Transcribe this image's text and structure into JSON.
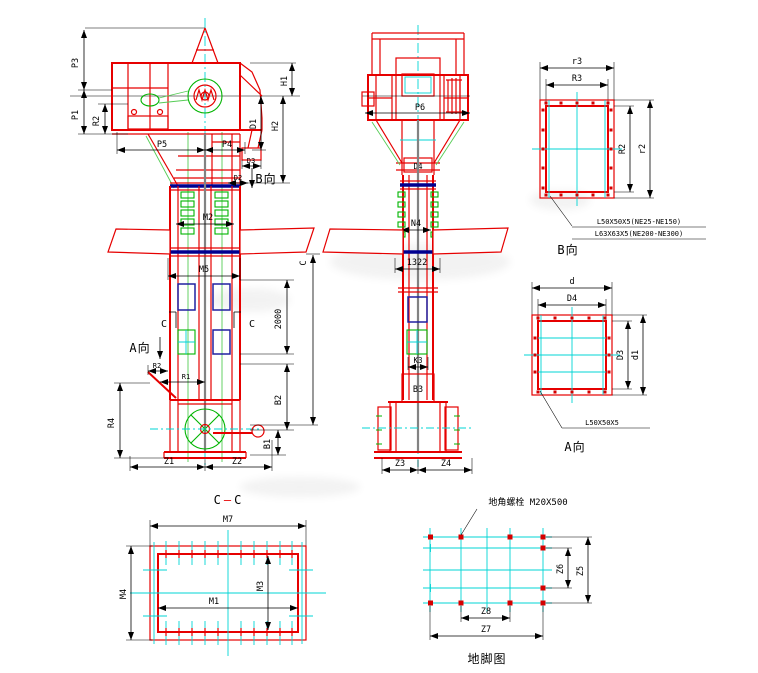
{
  "drawing": {
    "front": {
      "p3": "P3",
      "p1": "P1",
      "r2_head": "R2",
      "p5": "P5",
      "p4": "P4",
      "h1": "H1",
      "h2": "H2",
      "d1": "D1",
      "d3": "D3",
      "d2": "D2",
      "b_arrow": "B向",
      "m2": "M2",
      "m5": "M5",
      "dim_2000": "2000",
      "c_len": "C",
      "c_cut_left": "C",
      "c_cut_right": "C",
      "a_arrow": "A向",
      "r2": "R2",
      "r1": "R1",
      "r4": "R4",
      "b2": "B2",
      "b1": "B1",
      "z1": "Z1",
      "z2": "Z2"
    },
    "side": {
      "p6": "P6",
      "d4": "D4",
      "n4": "N4",
      "dim_1322": "1322",
      "k3": "K3",
      "b3": "B3",
      "z3": "Z3",
      "z4": "Z4"
    },
    "view_b": {
      "r3_outer": "r3",
      "r3_inner": "R3",
      "r2_inner": "R2",
      "r2_outer": "r2",
      "angle_note_small": "L50X50X5(NE25-NE150)",
      "angle_note_large": "L63X63X5(NE200-NE300)",
      "title": "B向"
    },
    "view_a": {
      "d_outer": "d",
      "d4_inner": "D4",
      "d3": "D3",
      "d1": "d1",
      "angle_note": "L50X50X5",
      "title": "A向"
    },
    "section_cc": {
      "title_left": "C",
      "title_dash": "—",
      "title_right": "C",
      "m7": "M7",
      "m4": "M4",
      "m3": "M3",
      "m1": "M1"
    },
    "foundation": {
      "bolt_note": "地角螺栓 M20X500",
      "z6": "Z6",
      "z5": "Z5",
      "z8": "Z8",
      "z7": "Z7",
      "title": "地脚图"
    },
    "colors": {
      "structure_red": "#e60000",
      "detail_green": "#00b400",
      "centerline_cyan": "#00d4d4",
      "flange_navy": "#000090",
      "door_blue": "#2020a0",
      "dimension_black": "#000000",
      "belt_gray": "#828282",
      "background": "#ffffff"
    }
  }
}
